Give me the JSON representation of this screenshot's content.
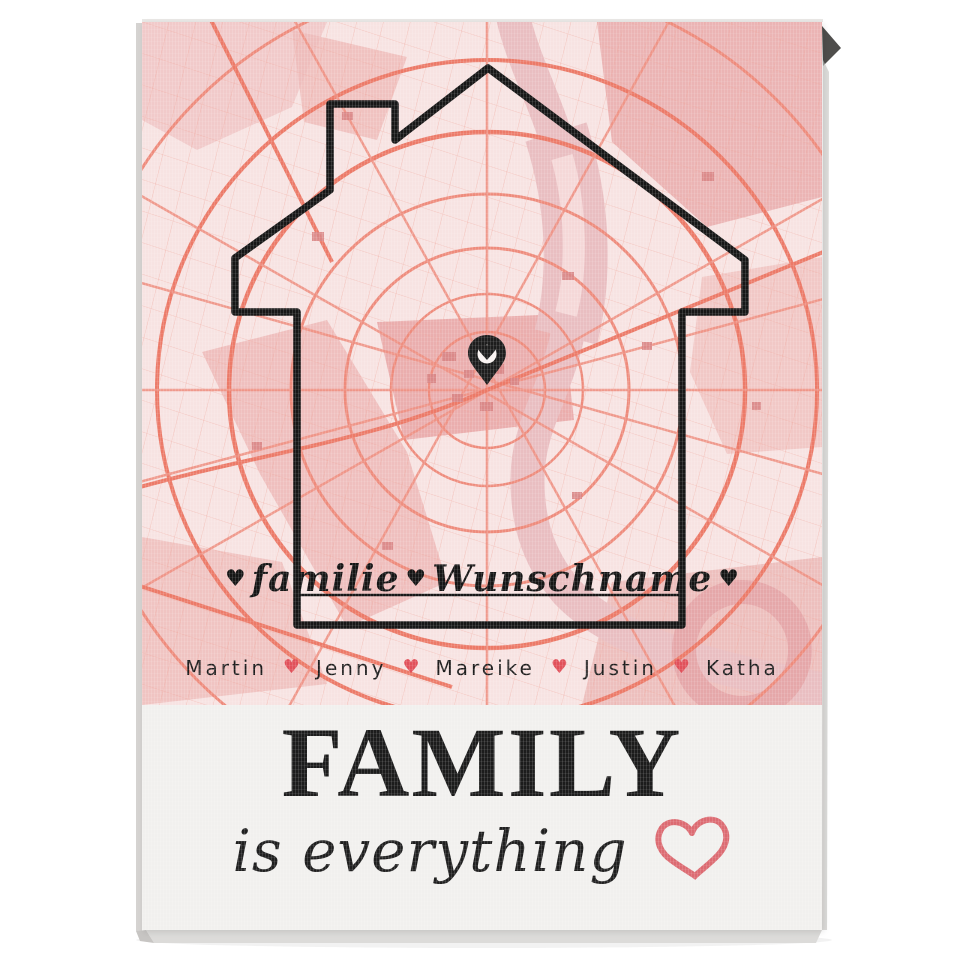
{
  "canvas_print": {
    "map_overlay": {
      "family_word": "familie",
      "custom_name": "Wunschname",
      "heart_char": "♥"
    },
    "names_row": {
      "names": [
        "Martin",
        "Jenny",
        "Mareike",
        "Justin",
        "Katha"
      ],
      "heart_char": "♥"
    },
    "caption": {
      "title": "FAMILY",
      "subtitle": "is everything"
    },
    "colors": {
      "map_background": "#f7e3e2",
      "map_road_salmon": "#ee8b7c",
      "map_road_major": "#ec7a68",
      "map_water_pink": "#e9bec1",
      "outline_black": "#171717",
      "name_heart_red": "#e1505a",
      "outline_heart_pink": "#dc6b72",
      "canvas_white": "#f1f0ee"
    }
  }
}
